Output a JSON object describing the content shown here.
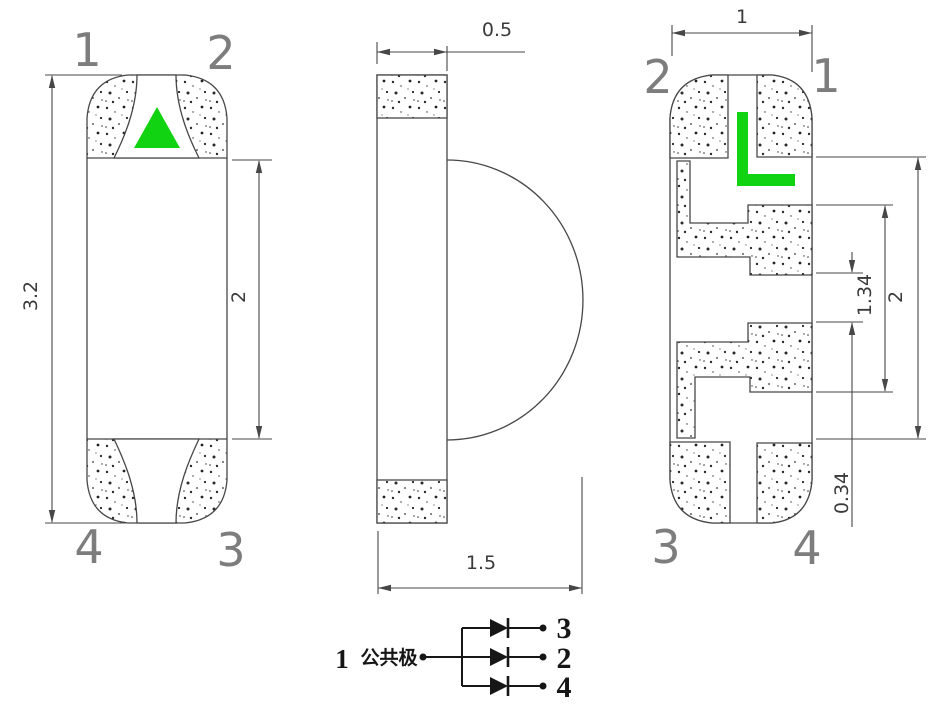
{
  "front_view": {
    "pin_top_left": "1",
    "pin_top_right": "2",
    "pin_bottom_left": "4",
    "pin_bottom_right": "3",
    "dim_overall_height": "3.2",
    "dim_body_height": "2"
  },
  "side_view": {
    "dim_body_thickness": "0.5",
    "dim_overall_thickness": "1.5"
  },
  "back_view": {
    "pin_top_left": "2",
    "pin_top_right": "1",
    "pin_bottom_left": "3",
    "pin_bottom_right": "4",
    "dim_width": "1",
    "dim_body_height": "2",
    "dim_pad_span": "1.34",
    "dim_pad_gap": "0.34"
  },
  "schematic": {
    "common_pin_number": "1",
    "common_pin_label": "公共极",
    "branch_top_pin": "3",
    "branch_middle_pin": "2",
    "branch_bottom_pin": "4"
  },
  "colors": {
    "marker_green": "#12D312",
    "line_gray": "#474747",
    "pin_label_gray": "#7d7d7d",
    "dim_text_gray": "#3a3a3a",
    "schematic_black": "#161616"
  }
}
